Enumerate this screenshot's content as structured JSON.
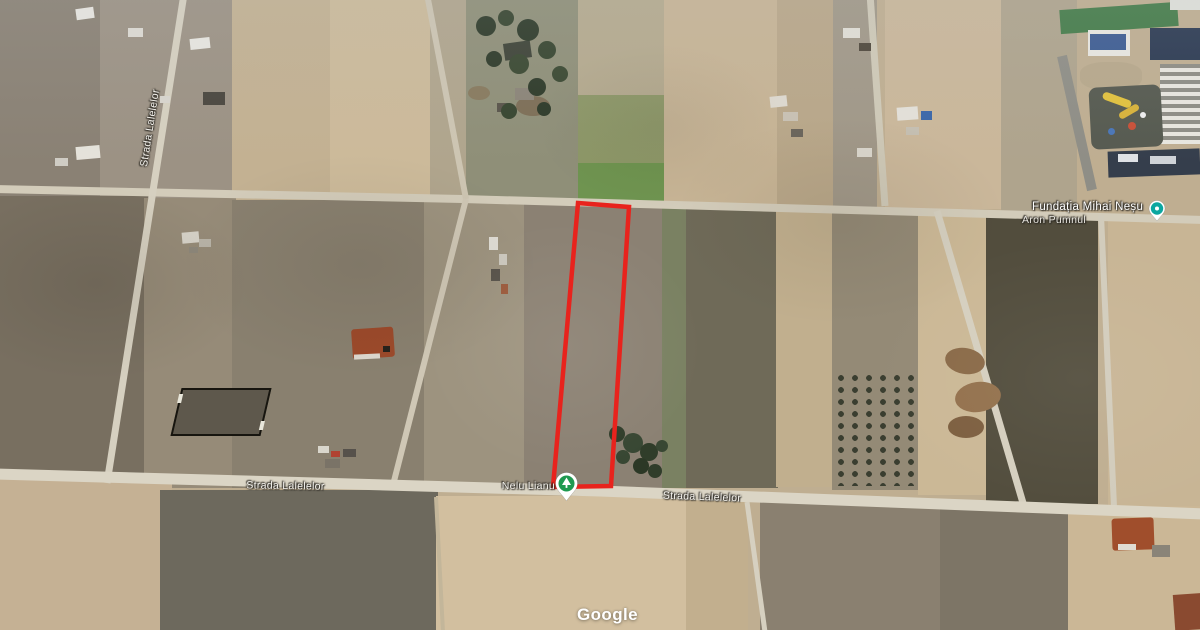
{
  "map": {
    "watermark": "Google",
    "street_labels": [
      {
        "text": "Strada Lalelelor"
      },
      {
        "text": "Strada Lalelelor"
      },
      {
        "text": "Strada Lalelelor"
      }
    ],
    "place_label": "Nelu Lianu",
    "poi_label": "Fundația Mihai Neșu",
    "poi_sublabel": "Aron Pumnul",
    "parcel": {
      "outline_points": "578,203 629,207 611,486 553,487",
      "outline_color": "#e8231d",
      "outline_width": "4.5"
    },
    "markers": {
      "place_marker_color": "#1f9950",
      "poi_marker_color": "#0ba7a0"
    }
  }
}
